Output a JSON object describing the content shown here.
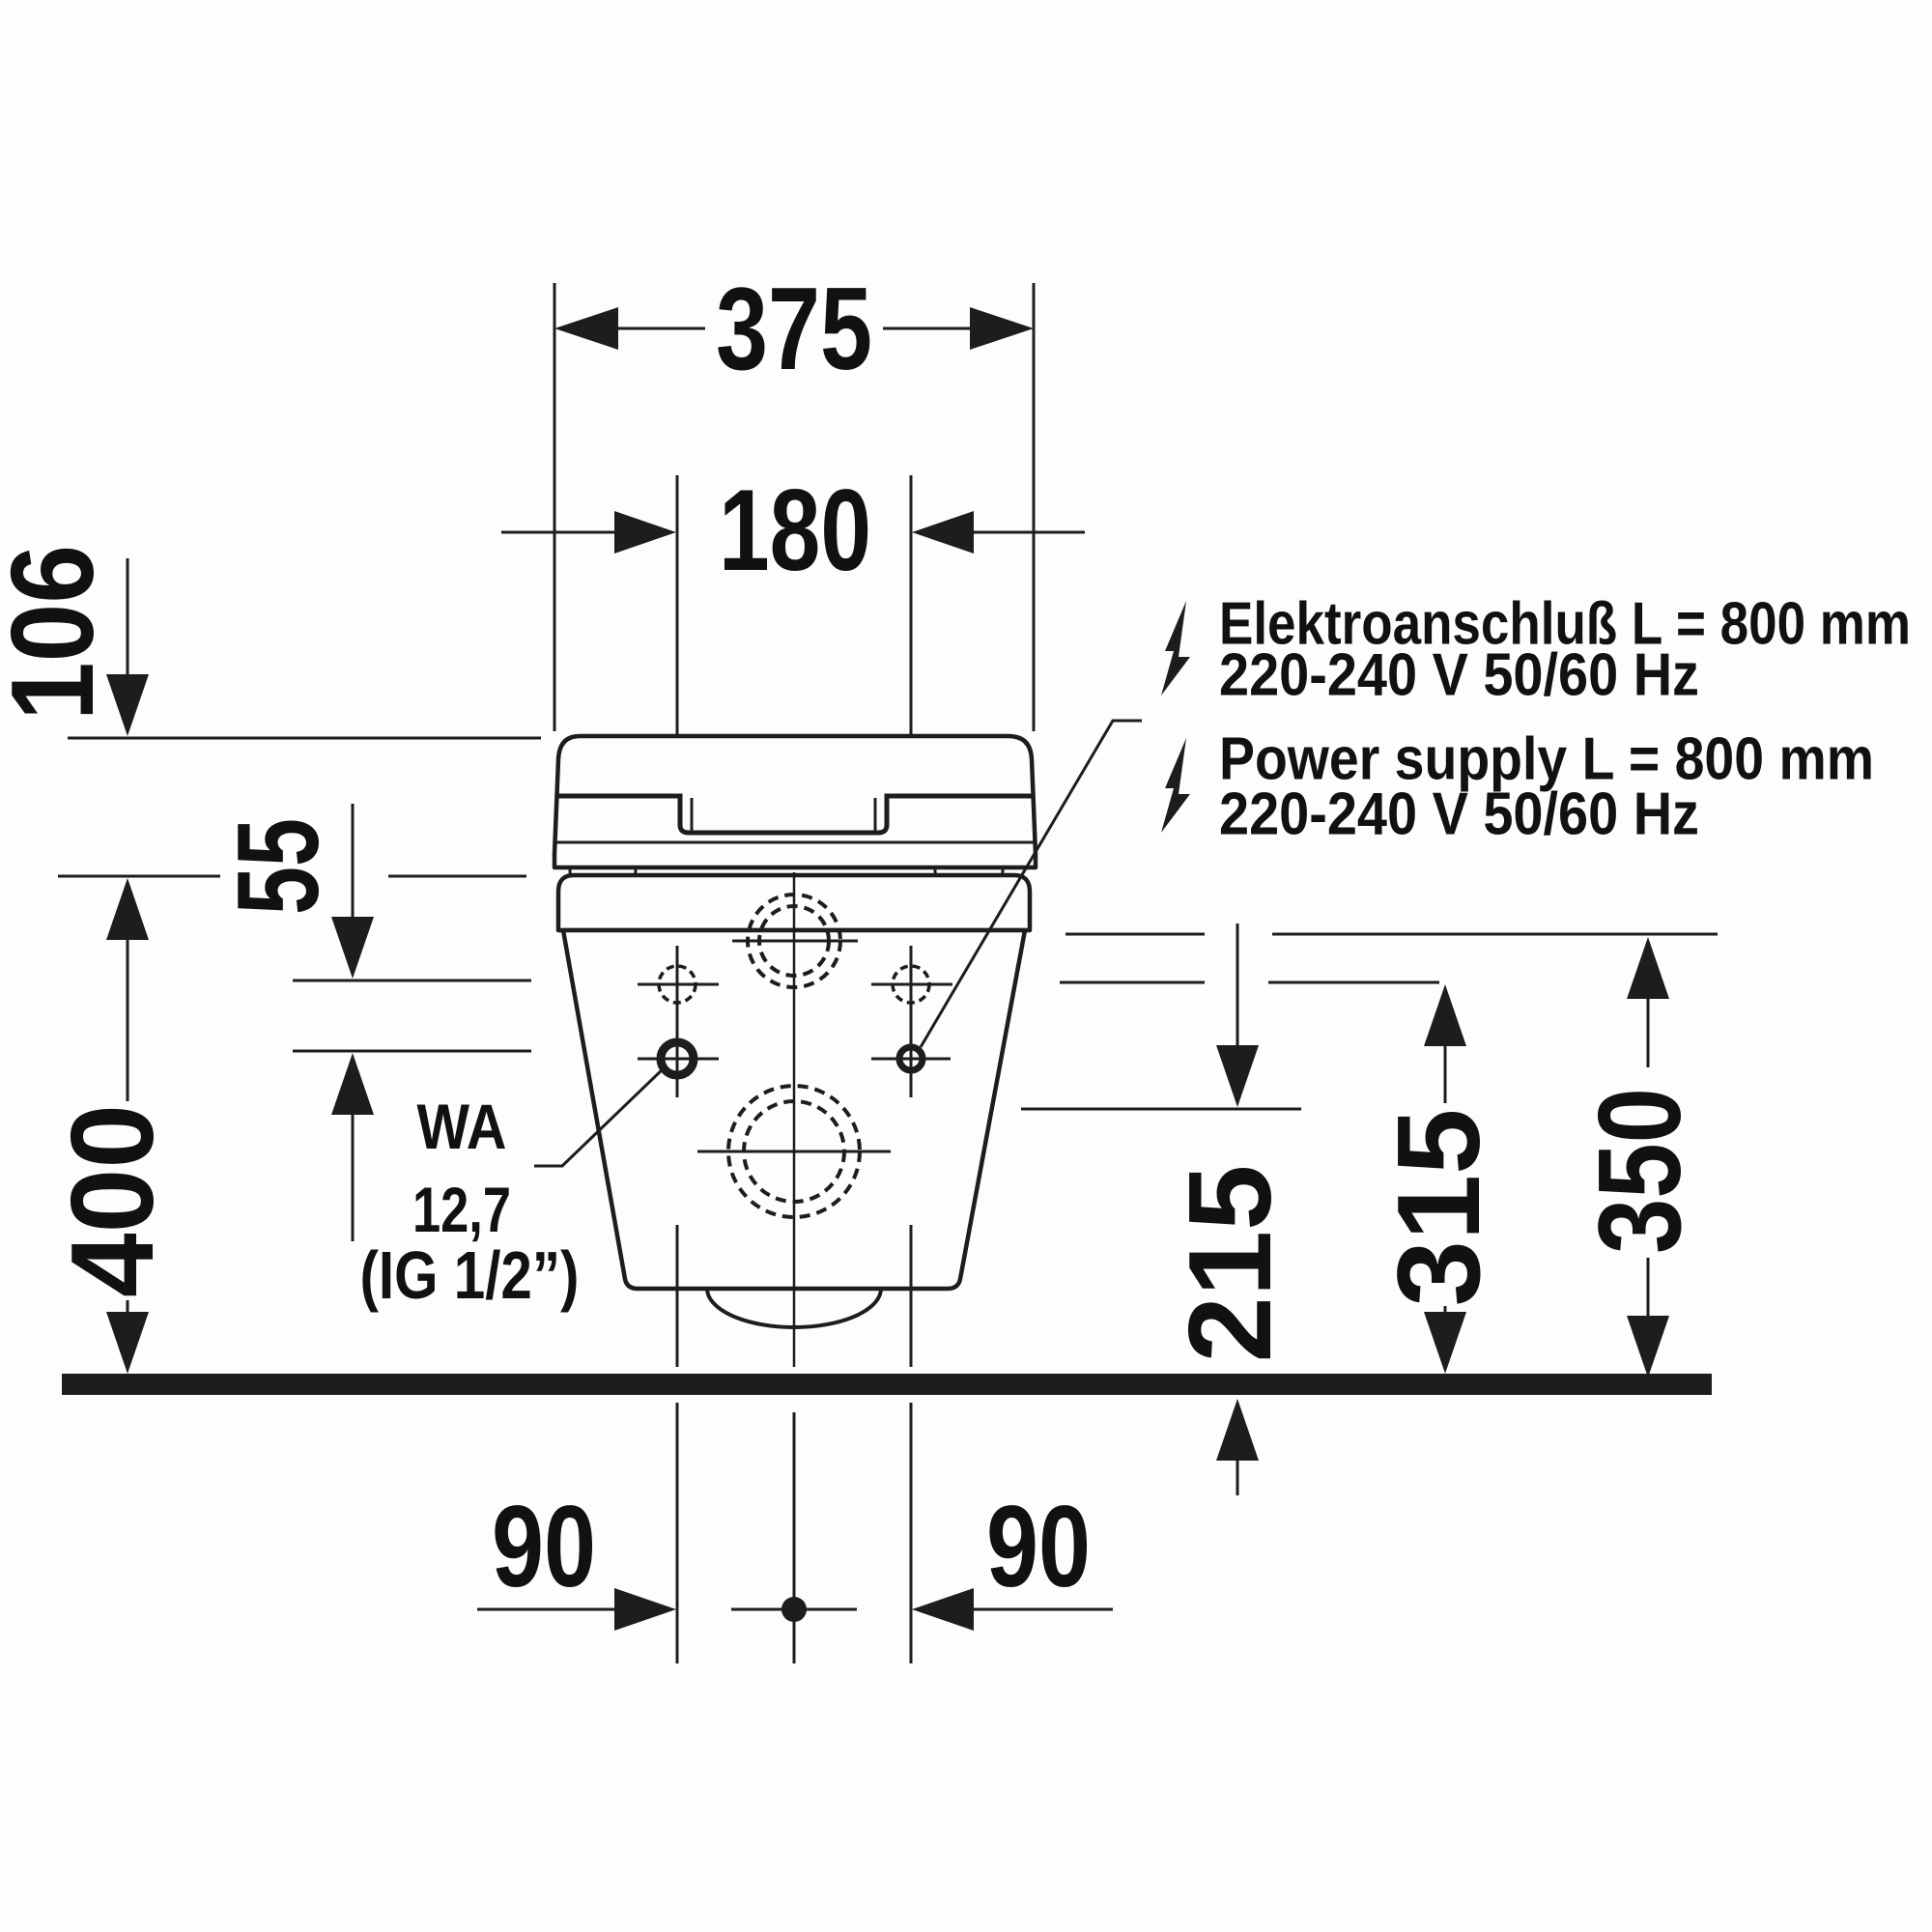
{
  "drawing": {
    "type": "technical-installation-diagram",
    "subject": "wall-hung toilet front view with mounting dimensions",
    "units": "mm",
    "colors": {
      "line": "#1d1d1d",
      "text": "#111111",
      "background": "#fdfdfd"
    },
    "dimensions": {
      "overall_width": "375",
      "connection_spacing": "180",
      "seat_lid_height": "106",
      "connection_row_gap": "55",
      "height_top": "400",
      "height_low": "215",
      "height_mid": "315",
      "height_high": "350",
      "bottom_offset_left": "90",
      "bottom_offset_right": "90"
    },
    "water_note": {
      "line1": "WA",
      "line2": "12,7",
      "line3": "(IG 1/2”)"
    },
    "electrical_note": {
      "de_line1": "Elektroanschluß L = 800 mm",
      "de_line2": "220-240 V  50/60 Hz",
      "en_line1": "Power supply L = 800 mm",
      "en_line2": "220-240 V  50/60 Hz"
    }
  }
}
